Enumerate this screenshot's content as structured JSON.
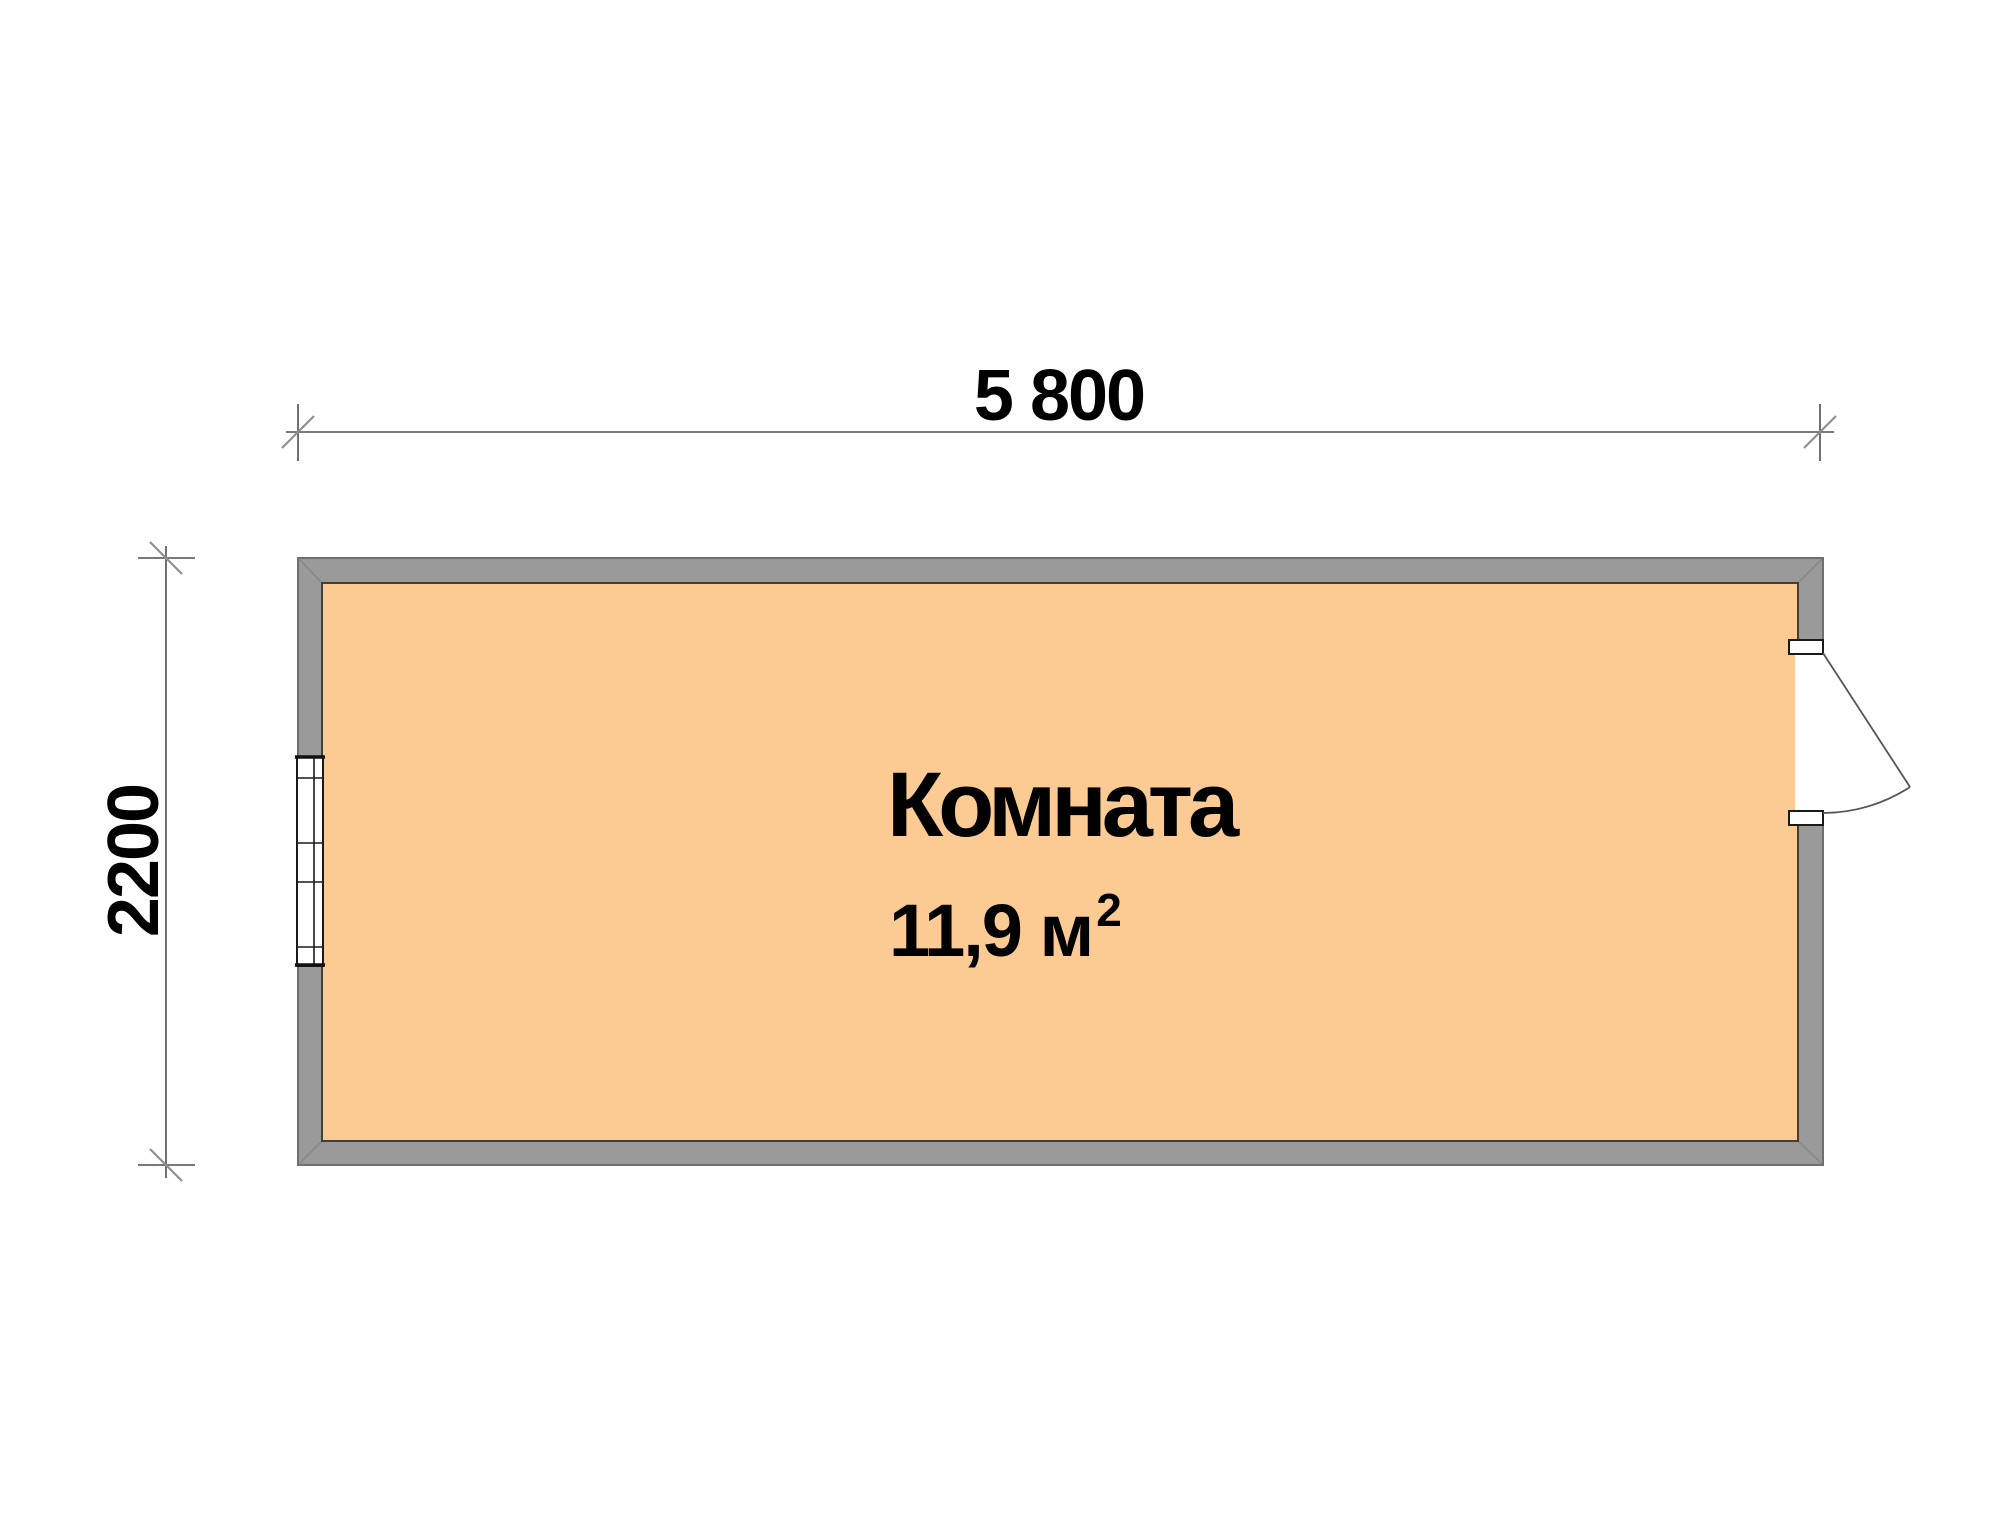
{
  "document": {
    "type": "floor-plan"
  },
  "dimensions": {
    "width": {
      "label": "5 800"
    },
    "height": {
      "label": "2200"
    }
  },
  "room": {
    "name": "Комната",
    "area": "11,9 м",
    "area_superscript": "2"
  },
  "features": {
    "window": "window-symbol",
    "door": "door-swing-symbol"
  },
  "colors": {
    "background": "#ffffff",
    "wall_fill": "#9a9a9a",
    "wall_outline": "#6f6f6f",
    "room_fill": "#fccb93",
    "room_outline": "#443e35",
    "dimension_line": "#4d4d4d",
    "tick_slash": "#8f8f8f",
    "window_frame": "#1a1a1a",
    "door_line": "#555555",
    "text": "#000000"
  }
}
